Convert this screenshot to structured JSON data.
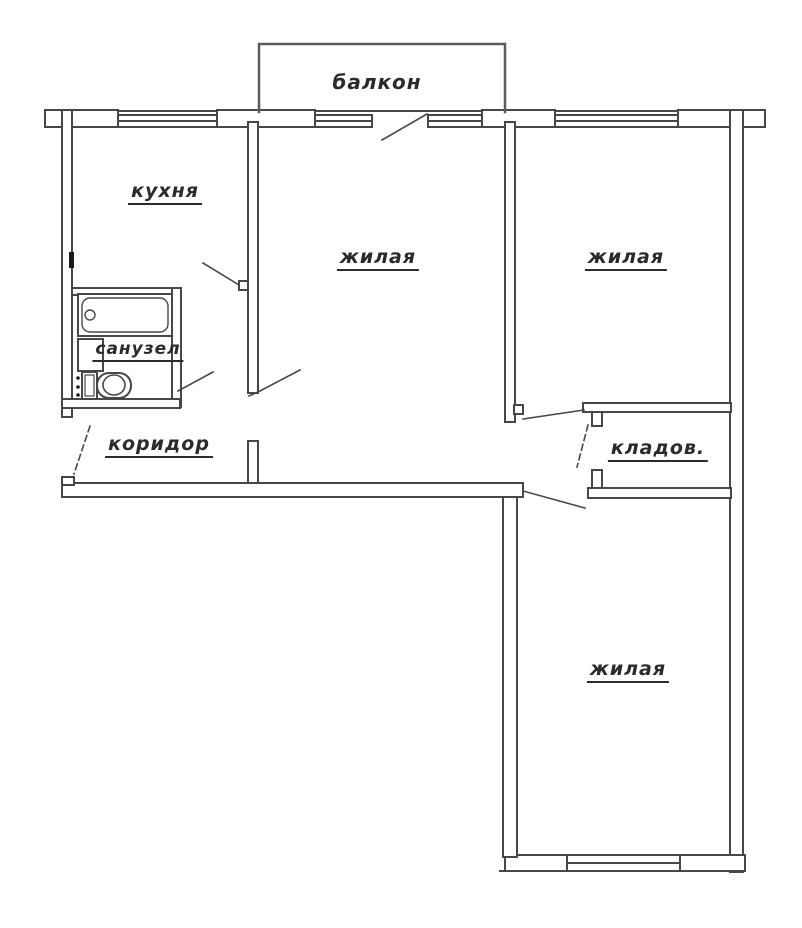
{
  "plan_title": "apartment floor plan (3-room)",
  "rooms": {
    "balcony": {
      "label": "балкон"
    },
    "kitchen": {
      "label": "кухня"
    },
    "living_top": {
      "label": "жилая"
    },
    "living_right": {
      "label": "жилая"
    },
    "living_bottom": {
      "label": "жилая"
    },
    "bathroom": {
      "label": "санузел"
    },
    "corridor": {
      "label": "коридор"
    },
    "storage": {
      "label": "кладов."
    }
  },
  "colors": {
    "wall_stroke": "#474747",
    "background": "#ffffff",
    "label_text": "#2b2b2b"
  },
  "symbols": [
    "window",
    "door-swing",
    "bathtub",
    "sink",
    "toilet",
    "balcony-rail"
  ]
}
